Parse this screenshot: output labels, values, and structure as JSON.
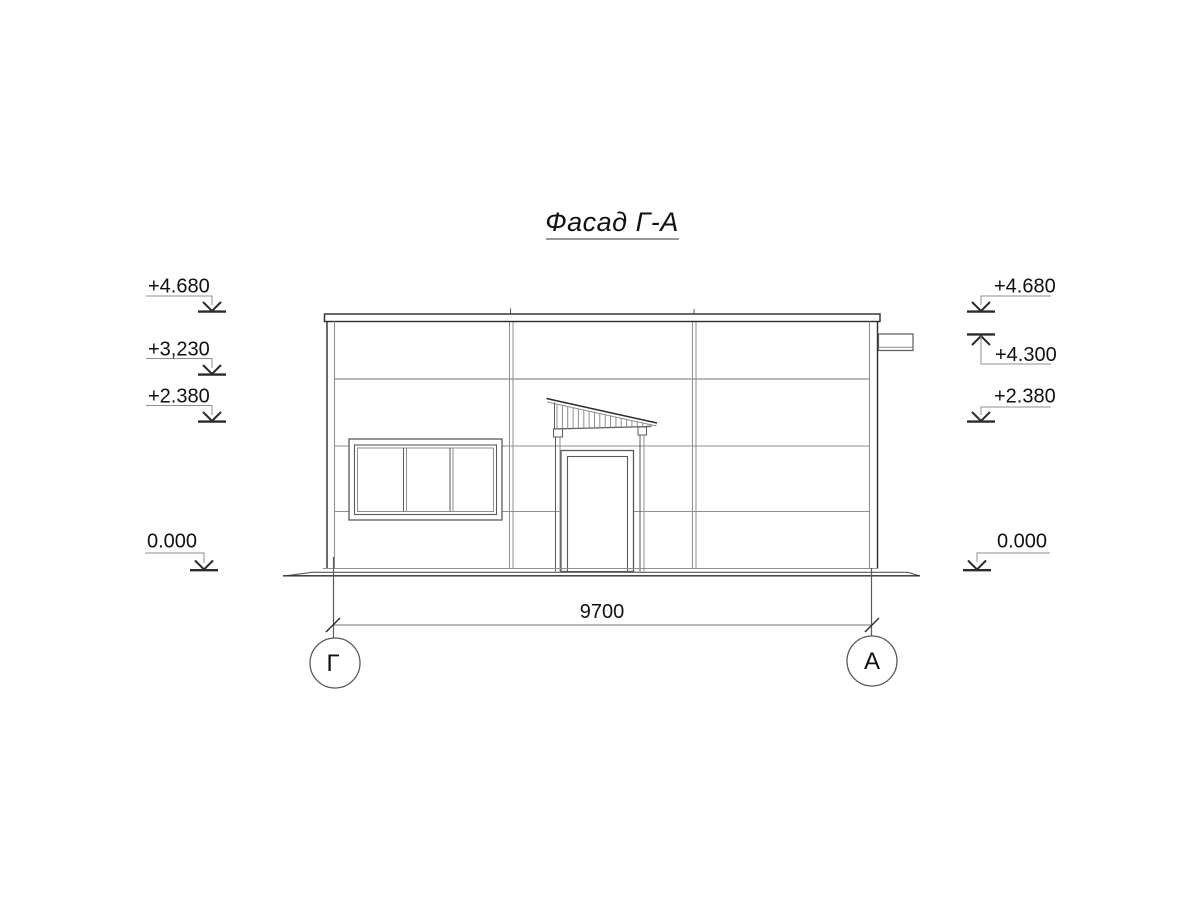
{
  "drawing": {
    "title": "Фасад Г-А",
    "levels_left": [
      {
        "label": "+4.680"
      },
      {
        "label": "+3,230"
      },
      {
        "label": "+2.380"
      },
      {
        "label": "0.000"
      }
    ],
    "levels_right": [
      {
        "label": "+4.680"
      },
      {
        "label": "+4.300"
      },
      {
        "label": "+2.380"
      },
      {
        "label": "0.000"
      }
    ],
    "dimension": {
      "value": "9700"
    },
    "axes": [
      {
        "label": "Г"
      },
      {
        "label": "А"
      }
    ],
    "colors": {
      "line_dark": "#2b2b2b",
      "line_thin": "#8f8f8f",
      "background": "#ffffff",
      "text": "#111111"
    }
  }
}
